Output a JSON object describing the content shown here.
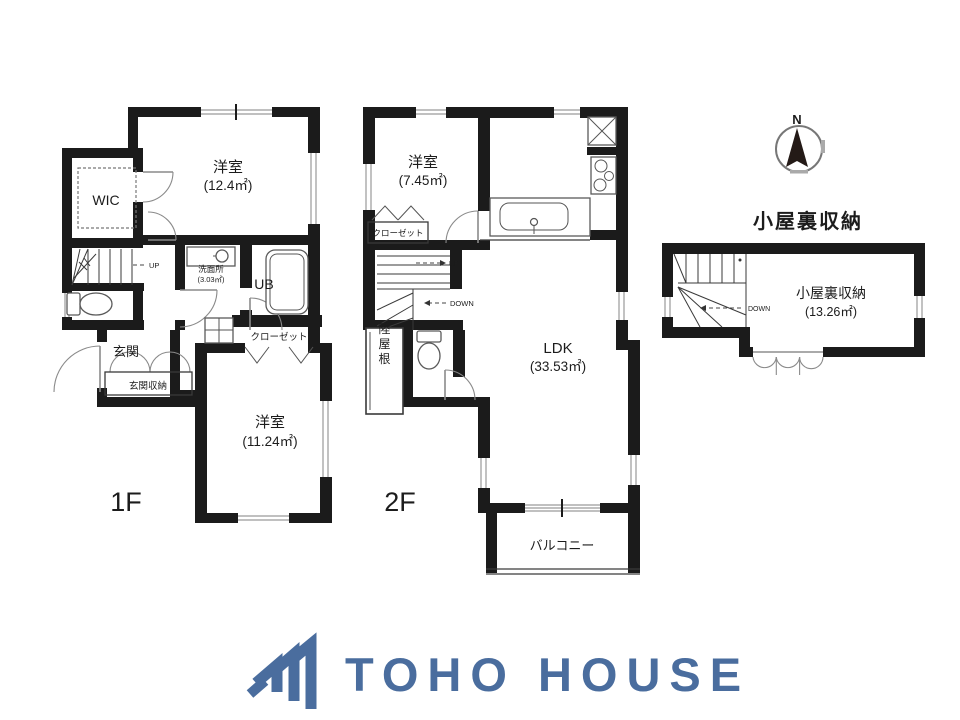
{
  "colors": {
    "wall": "#1b1b1b",
    "logo_blue": "#4a6d9e"
  },
  "plan_1f": {
    "floor_label": "1F",
    "bedroom_north": {
      "name": "洋室",
      "area": "(12.4㎡)"
    },
    "wic": "WIC",
    "up": "UP",
    "washroom": {
      "name": "洗面所",
      "area": "(3.03㎡)"
    },
    "bath": "UB",
    "closet": "クローゼット",
    "entrance": "玄関",
    "entrance_storage": "玄関収納",
    "bedroom_south": {
      "name": "洋室",
      "area": "(11.24㎡)"
    }
  },
  "plan_2f": {
    "floor_label": "2F",
    "bedroom": {
      "name": "洋室",
      "area": "(7.45㎡)"
    },
    "closet": "クローゼット",
    "up": "UP",
    "down": "DOWN",
    "flat_roof": "陸屋根",
    "ldk": {
      "name": "LDK",
      "area": "(33.53㎡)"
    },
    "balcony": "バルコニー"
  },
  "attic": {
    "title": "小屋裏収納",
    "room": {
      "name": "小屋裏収納",
      "area": "(13.26㎡)"
    },
    "down": "DOWN",
    "compass_north": "N"
  },
  "logo": {
    "brand": "TOHO HOUSE"
  }
}
